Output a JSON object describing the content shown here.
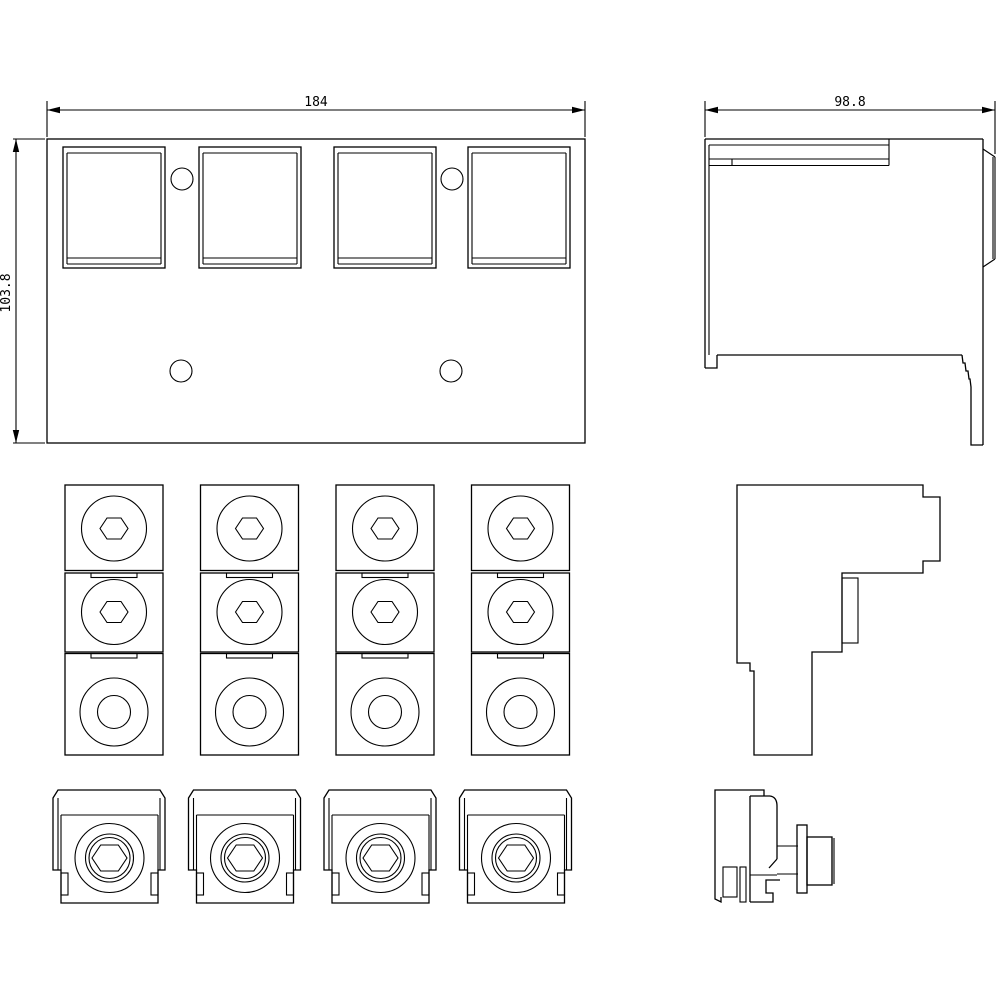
{
  "page": {
    "background": "#ffffff",
    "line_color": "#000000",
    "text_color": "#000000"
  },
  "dimensions": {
    "front_width_label": "184",
    "front_height_label": "103.8",
    "side_depth_label": "98.8"
  },
  "counts": {
    "front_windows": 4,
    "terminal_columns": 4,
    "blocks_per_column": 3,
    "clamp_lugs": 4
  }
}
